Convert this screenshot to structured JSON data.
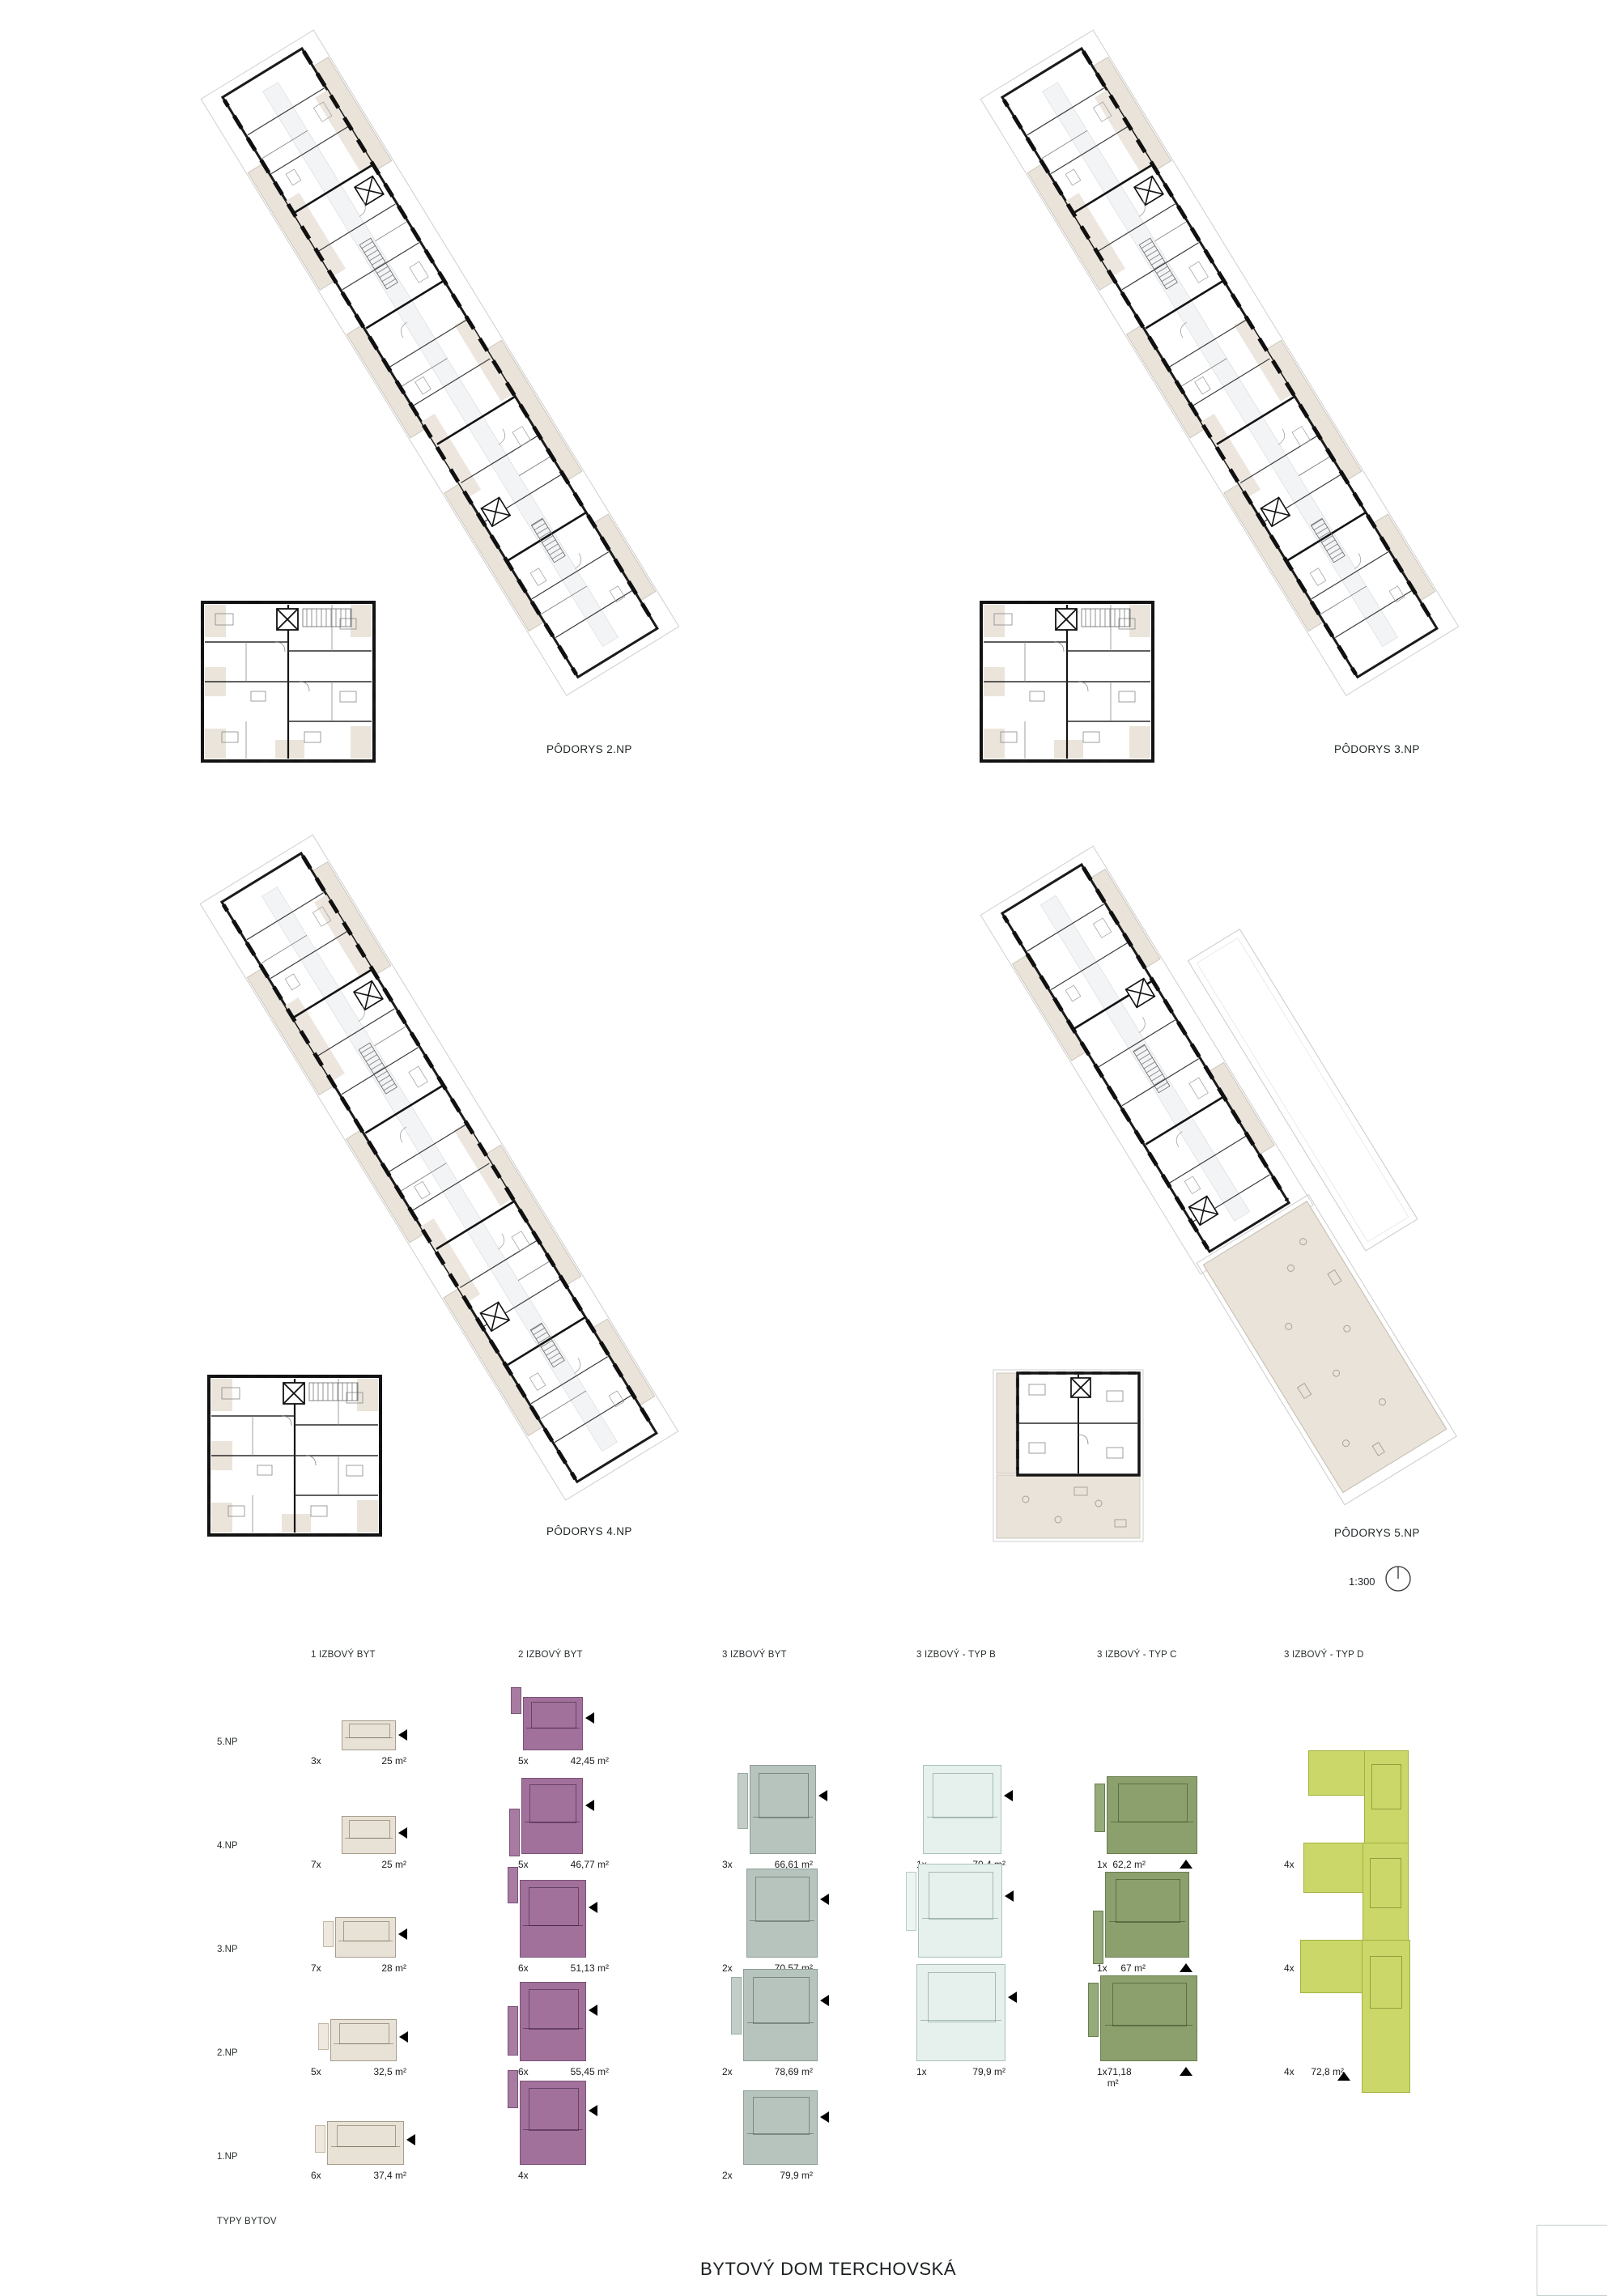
{
  "sheet": {
    "title": "BYTOVÝ DOM TERCHOVSKÁ",
    "scale_label": "1:300"
  },
  "plans": [
    {
      "id": "2np",
      "label": "PÔDORYS 2.NP"
    },
    {
      "id": "3np",
      "label": "PÔDORYS 3.NP"
    },
    {
      "id": "4np",
      "label": "PÔDORYS 4.NP"
    },
    {
      "id": "5np",
      "label": "PÔDORYS 5.NP"
    }
  ],
  "icons": {
    "north_icon": "circle-with-needle",
    "unit_marker_left": "◀",
    "unit_marker_up": "▲"
  },
  "colors": {
    "type_1_izbovy": "#e8e1d6",
    "type_2_izbovy": "#a1719c",
    "type_3_izbovy": "#b7c3bd",
    "type_3_typ_b": "#e6f0ec",
    "type_3_typ_c": "#8ba06d",
    "type_3_typ_d": "#cbd869",
    "balcony_beige": "#e9e3da",
    "wall_black": "#1b1b1b"
  },
  "legend": {
    "title": "TYPY BYTOV",
    "columns": [
      "1 IZBOVÝ BYT",
      "2 IZBOVÝ BYT",
      "3 IZBOVÝ BYT",
      "3 IZBOVÝ - TYP B",
      "3 IZBOVÝ - TYP C",
      "3 IZBOVÝ - TYP D"
    ],
    "rows": [
      {
        "floor": "5.NP",
        "cells": [
          {
            "count": "3x",
            "area": "25 m²"
          },
          {
            "count": "5x",
            "area": "42,45 m²"
          },
          null,
          null,
          null,
          null
        ]
      },
      {
        "floor": "4.NP",
        "cells": [
          {
            "count": "7x",
            "area": "25 m²"
          },
          {
            "count": "5x",
            "area": "46,77 m²"
          },
          {
            "count": "3x",
            "area": "66,61 m²"
          },
          {
            "count": "1x",
            "area": "70,4 m²"
          },
          {
            "count": "1x",
            "area": "62,2 m²"
          },
          {
            "count": "4x",
            "area": "62,8 m²"
          }
        ]
      },
      {
        "floor": "3.NP",
        "cells": [
          {
            "count": "7x",
            "area": "28 m²"
          },
          {
            "count": "6x",
            "area": "51,13 m²"
          },
          {
            "count": "2x",
            "area": "70,57 m²"
          },
          {
            "count": "1x",
            "area": "77,6 m²"
          },
          {
            "count": "1x",
            "area": "67 m²"
          },
          {
            "count": "4x",
            "area": "68,2 m²"
          }
        ]
      },
      {
        "floor": "2.NP",
        "cells": [
          {
            "count": "5x",
            "area": "32,5 m²"
          },
          {
            "count": "6x",
            "area": "55,45 m²"
          },
          {
            "count": "2x",
            "area": "78,69 m²"
          },
          {
            "count": "1x",
            "area": "79,9 m²"
          },
          {
            "count": "1x",
            "area": "71,18 m²"
          },
          {
            "count": "4x",
            "area": "72,8 m²"
          }
        ]
      },
      {
        "floor": "1.NP",
        "cells": [
          {
            "count": "6x",
            "area": "37,4 m²"
          },
          {
            "count": "4x",
            "area": ""
          },
          {
            "count": "2x",
            "area": "79,9 m²"
          },
          null,
          null,
          null
        ]
      }
    ]
  }
}
